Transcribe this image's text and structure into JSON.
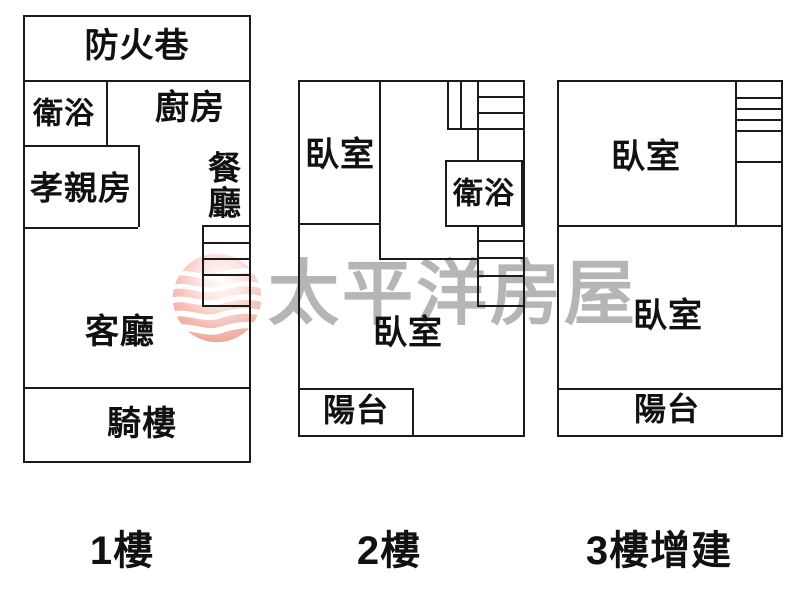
{
  "title": "apartment-floor-plan",
  "watermark": {
    "brand_text": "太平洋房屋",
    "logo_name": "pacific-house-sphere-logo",
    "text_color": "#b5b5b5",
    "logo_pink_light": "#fbdcd6",
    "logo_pink_deep": "#e98a7e"
  },
  "wall_color": "#1a1a1a",
  "floors": [
    {
      "label": "1樓",
      "rooms": {
        "fire_lane": "防火巷",
        "bathroom": "衛浴",
        "kitchen": "廚房",
        "parents_room": "孝親房",
        "dining_room": "餐廳",
        "living_room": "客廳",
        "arcade": "騎樓"
      }
    },
    {
      "label": "2樓",
      "rooms": {
        "bedroom_upper": "臥室",
        "bathroom": "衛浴",
        "bedroom_main": "臥室",
        "balcony": "陽台"
      }
    },
    {
      "label": "3樓增建",
      "rooms": {
        "bedroom_upper": "臥室",
        "bedroom_main": "臥室",
        "balcony": "陽台"
      }
    }
  ]
}
